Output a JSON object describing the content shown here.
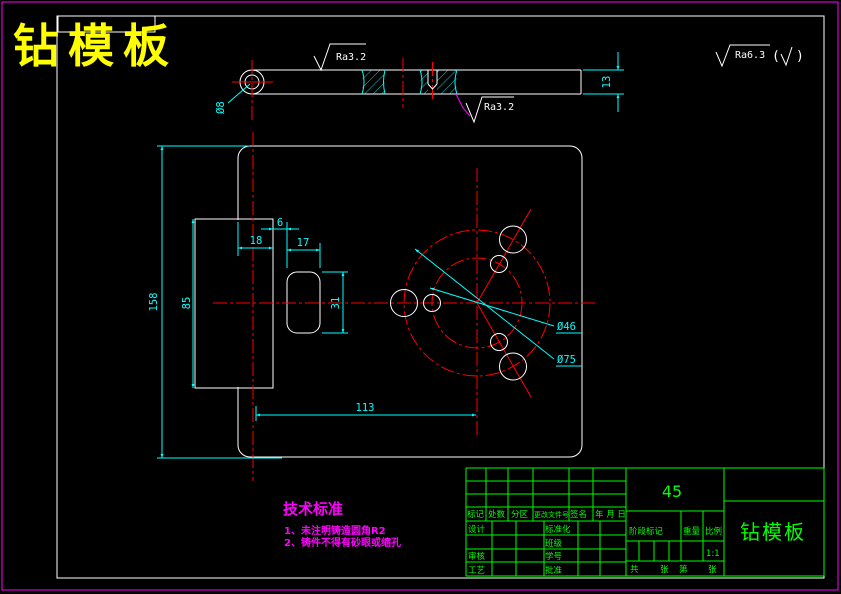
{
  "drawing_title": "钻模板",
  "colors": {
    "background": "#000000",
    "geometry": "#ffffff",
    "dimensions": "#00ffff",
    "centerlines": "#ff0000",
    "outer_border": "#ff00ff",
    "title_block": "#00ff00",
    "main_title": "#ffff00",
    "notes": "#ff00ff"
  },
  "top_view": {
    "hole_label": "Ø8",
    "thickness_dim": "13",
    "surface_top": "Ra3.2",
    "surface_bottom": "Ra3.2"
  },
  "corner_finish": {
    "value": "Ra6.3",
    "paren_open": "(",
    "check": "√",
    "paren_close": ")"
  },
  "front_view": {
    "height_dim": "158",
    "tab_height_dim": "85",
    "notch_dim": "18",
    "offset_dim": "6",
    "slot_width_dim": "17",
    "slot_height_dim": "31",
    "center_dist_dim": "113",
    "bolt_circle_small": "Ø46",
    "bolt_circle_large": "Ø75"
  },
  "tech_notes": {
    "title": "技术标准",
    "line1": "1、未注明铸造圆角R2",
    "line2": "2、铸件不得有砂眼或缩孔"
  },
  "title_block": {
    "material": "45",
    "part_name": "钻模板",
    "scale_value": "1:1",
    "rev_labels": [
      "标记",
      "处数",
      "分区",
      "更改文件号",
      "签名",
      "年 月 日"
    ],
    "role_labels": [
      "设计",
      "审核",
      "工艺"
    ],
    "mid_labels": [
      "标准化",
      "班级",
      "学号",
      "批准"
    ],
    "info_labels": [
      "阶段标记",
      "重量",
      "比例"
    ],
    "sheet_labels": [
      "共",
      "张",
      "第",
      "张"
    ]
  }
}
